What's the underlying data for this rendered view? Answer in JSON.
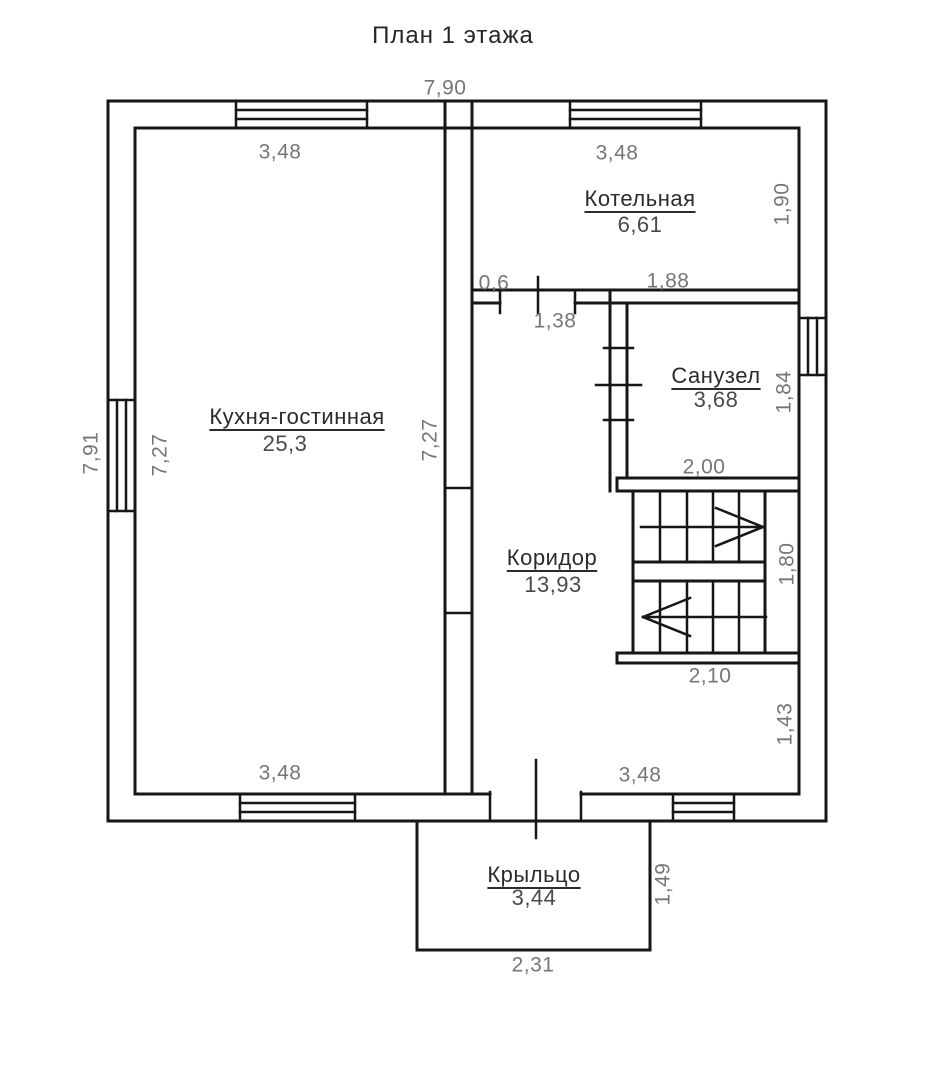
{
  "title": "План 1 этажа",
  "rooms": {
    "kitchen": {
      "name": "Кухня-гостинная",
      "area": "25,3"
    },
    "boiler": {
      "name": "Котельная",
      "area": "6,61"
    },
    "bathroom": {
      "name": "Санузел",
      "area": "3,68"
    },
    "corridor": {
      "name": "Коридор",
      "area": "13,93"
    },
    "porch": {
      "name": "Крыльцо",
      "area": "3,44"
    }
  },
  "dims": {
    "total_width": "7,90",
    "total_height": "7,91",
    "kitchen_width_top": "3,48",
    "kitchen_width_bottom": "3,48",
    "kitchen_height_left": "7,27",
    "kitchen_height_right": "7,27",
    "boiler_width": "3,48",
    "boiler_height": "1,90",
    "boiler_wall_left": "0,6",
    "boiler_wall_right": "1,88",
    "boiler_door_width": "1,38",
    "bathroom_height": "1,84",
    "bathroom_width": "2,00",
    "stairs_height": "1,80",
    "stairs_width": "2,10",
    "understairs_height": "1,43",
    "hall_width_bottom": "3,48",
    "porch_height": "1,49",
    "porch_width": "2,31"
  },
  "colors": {
    "line": "#161616",
    "dimension_text": "#767676",
    "room_name_text": "#2b2b2b",
    "room_area_text": "#4a4a4a",
    "background": "#ffffff"
  }
}
